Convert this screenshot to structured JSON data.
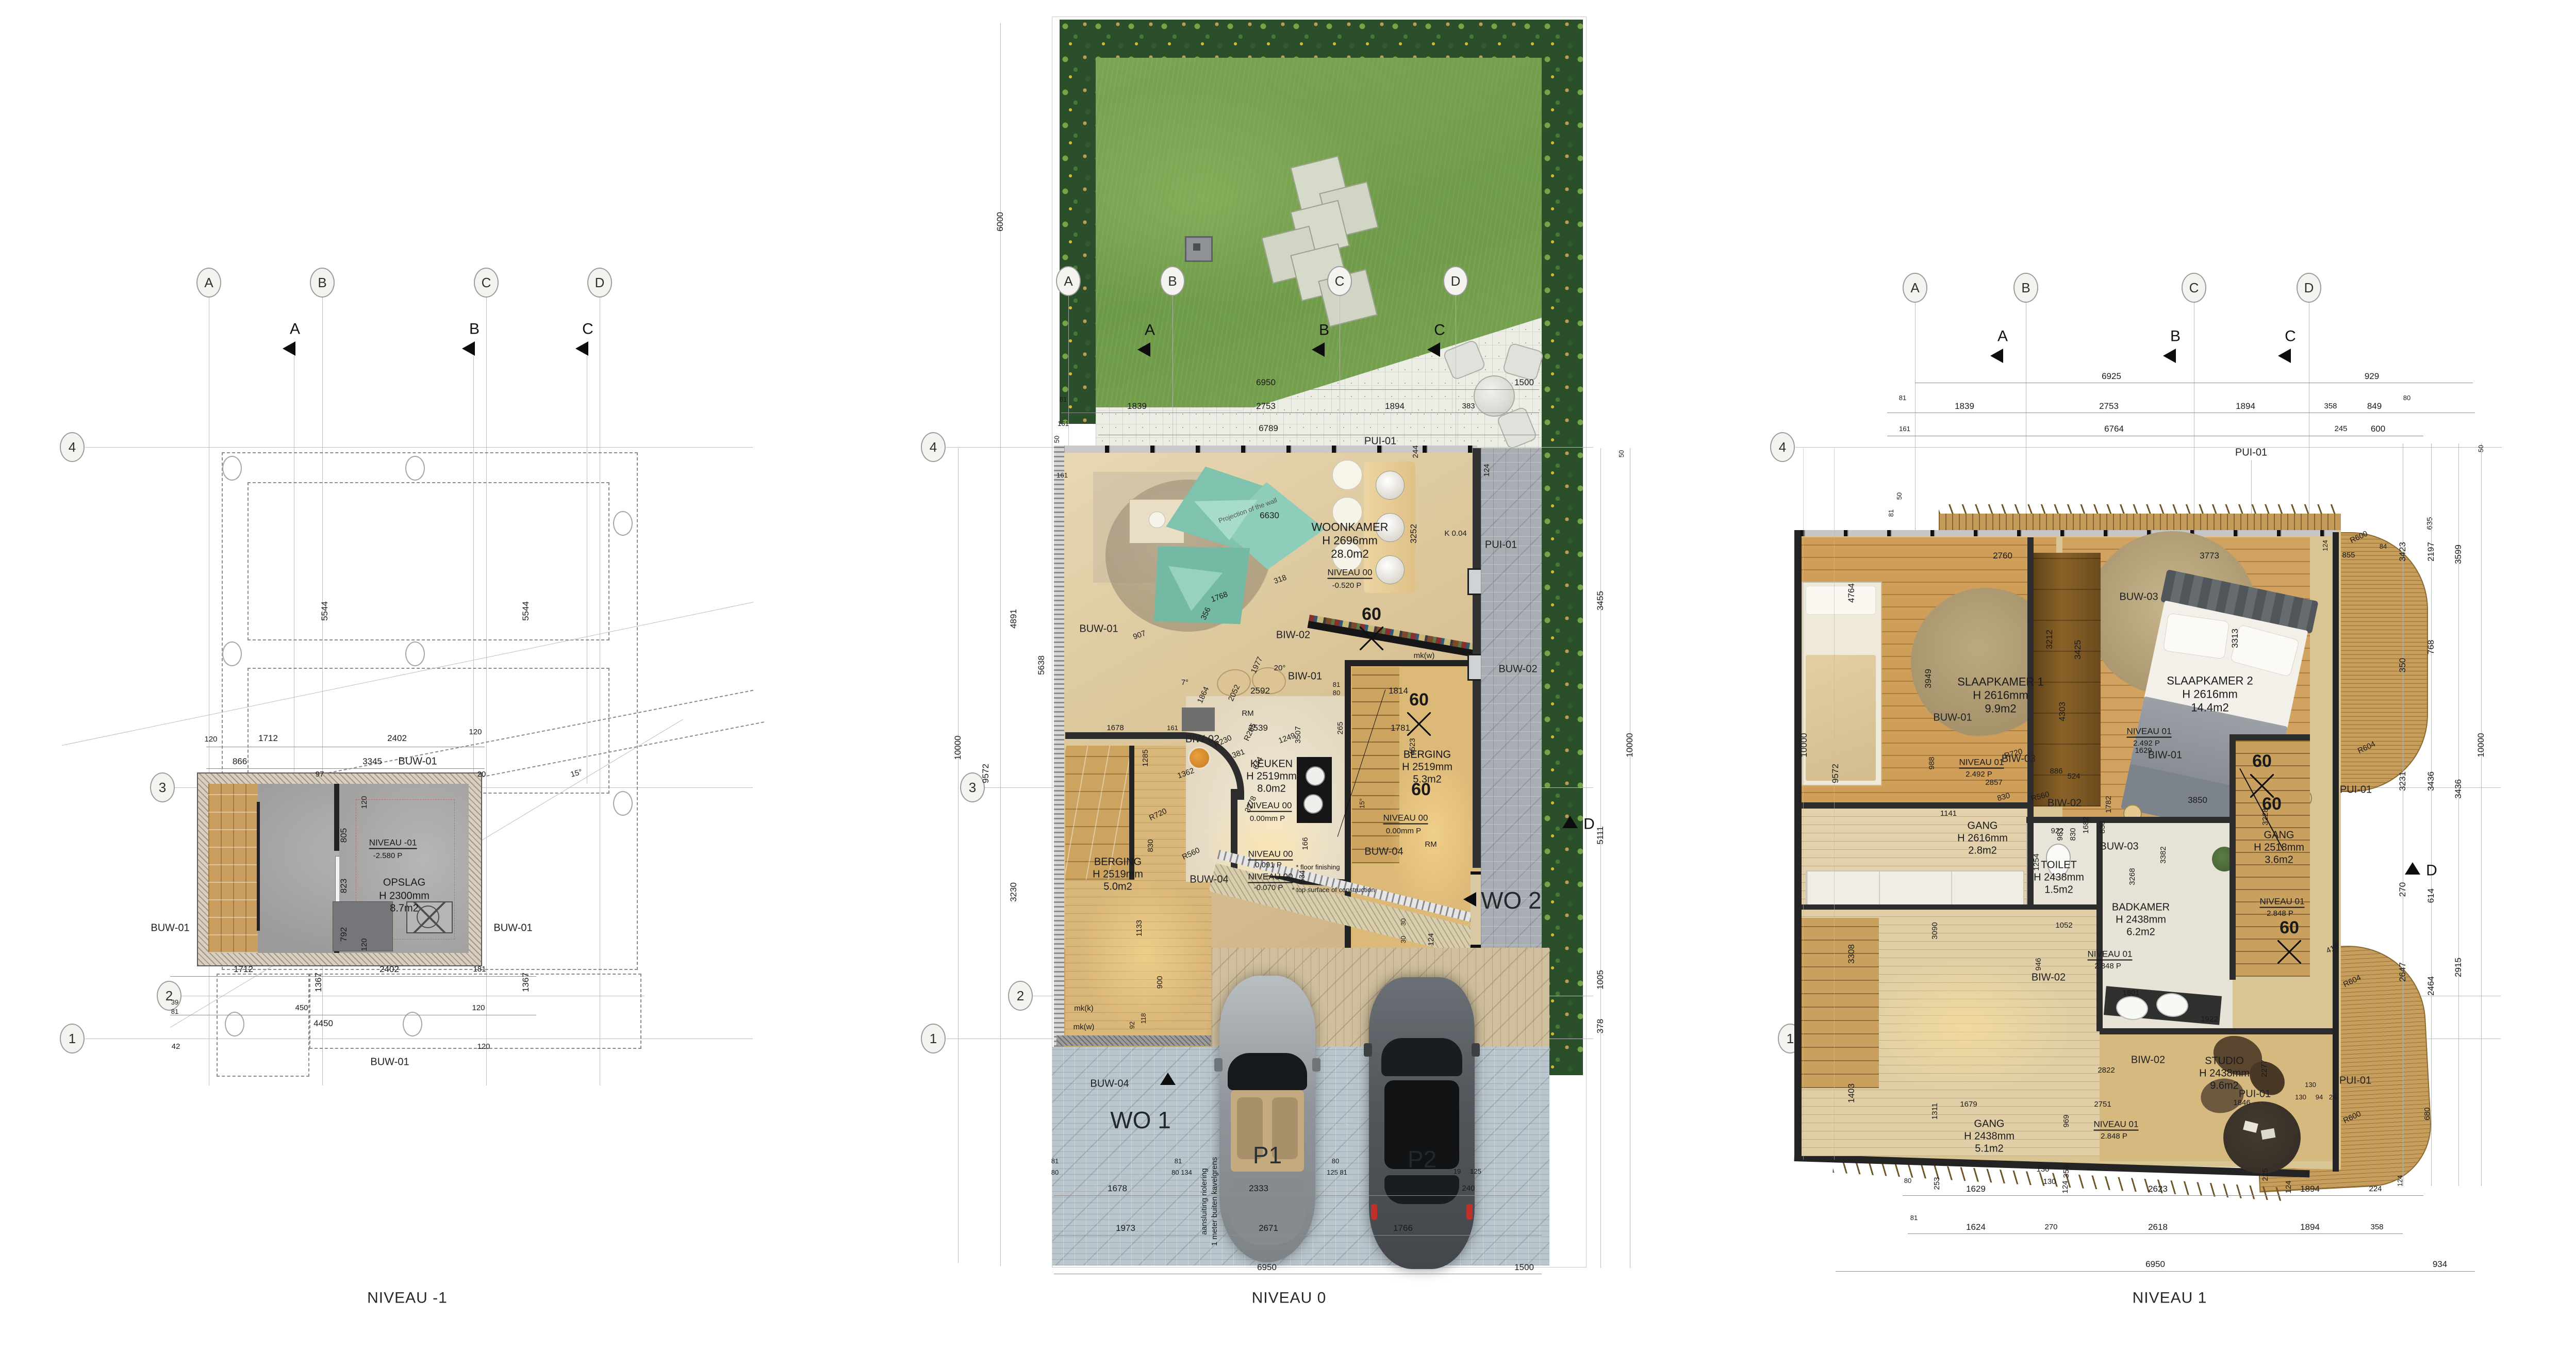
{
  "grid": {
    "cols": [
      "A",
      "B",
      "C",
      "D"
    ],
    "rows": [
      "4",
      "3",
      "2",
      "1"
    ],
    "secs": [
      "A",
      "B",
      "C"
    ],
    "dsec": "D"
  },
  "m1": {
    "title": "NIVEAU -1",
    "room": [
      "OPSLAG",
      "H 2300mm",
      "8.7m2"
    ],
    "lvl": [
      "NIVEAU -01",
      "-2.580 P"
    ],
    "buw": "BUW-01",
    "d": [
      "120",
      "1712",
      "2402",
      "120",
      "866",
      "97",
      "3345",
      "20",
      "805",
      "823",
      "792",
      "120",
      "120",
      "5544",
      "5544",
      "1712",
      "1367",
      "2402",
      "181",
      "1367",
      "39",
      "81",
      "450",
      "4450",
      "120",
      "42",
      "120",
      "15°"
    ]
  },
  "n0": {
    "title": "NIVEAU 0",
    "wk": [
      "WOONKAMER",
      "H 2696mm",
      "28.0m2"
    ],
    "kk": [
      "KEUKEN",
      "H 2519mm",
      "8.0m2"
    ],
    "bgr": [
      "BERGING",
      "H 2519mm",
      "5.3m2"
    ],
    "bgl": [
      "BERGING",
      "H 2519mm",
      "5.0m2"
    ],
    "lv1": [
      "NIVEAU 00",
      "-0.520 P"
    ],
    "lv2": [
      "NIVEAU 00",
      "0.00mm P"
    ],
    "lv3": [
      "NIVEAU 00",
      "0.091 P",
      "* floor finishing"
    ],
    "lv4": [
      "NIVEAU 00",
      "-0.070 P",
      "* top surface of construction"
    ],
    "buw01": "BUW-01",
    "buw02": "BUW-02",
    "buw04": "BUW-04",
    "biw01": "BIW-01",
    "biw02": "BIW-02",
    "pui": "PUI-01",
    "proj": "Projection of the wall",
    "rm": "RM",
    "k004": "K 0.04",
    "mkw": "mk(w)",
    "mkk": "mk(k)",
    "wo1": "WO 1",
    "wo2": "WO 2",
    "p1": "P1",
    "p2": "P2",
    "note": [
      "aansluiting riolering",
      "1 meter buiten kavelgrens"
    ],
    "d": [
      "6950",
      "1500",
      "81",
      "1839",
      "2753",
      "1894",
      "383",
      "161",
      "6789",
      "6630",
      "318",
      "1768",
      "356",
      "907",
      "1977",
      "20°",
      "7°",
      "1864",
      "2052",
      "R230",
      "R285",
      "381",
      "644",
      "1249",
      "1362",
      "R720",
      "R560",
      "3252",
      "124",
      "244",
      "50",
      "2592",
      "2539",
      "3507",
      "3278",
      "1678",
      "161",
      "161",
      "1285",
      "830",
      "1133",
      "900",
      "92",
      "118",
      "265",
      "81",
      "80",
      "1814",
      "1781",
      "4523",
      "15°",
      "166",
      "534",
      "30",
      "30",
      "124",
      "1678",
      "1973",
      "2333",
      "2671",
      "6950",
      "1500",
      "1766",
      "240",
      "19",
      "125",
      "80",
      "125 81",
      "81",
      "80 134",
      "81",
      "80",
      "6000",
      "10000",
      "9572",
      "4891",
      "5638",
      "3230",
      "3455",
      "10000",
      "5111",
      "1005",
      "378",
      "50",
      "60",
      "60",
      "60"
    ]
  },
  "n1": {
    "title": "NIVEAU 1",
    "sk1": [
      "SLAAPKAMER 1",
      "H 2616mm",
      "9.9m2"
    ],
    "sk2": [
      "SLAAPKAMER 2",
      "H 2616mm",
      "14.4m2"
    ],
    "g1": [
      "GANG",
      "H 2616mm",
      "2.8m2"
    ],
    "to": [
      "TOILET",
      "H 2438mm",
      "1.5m2"
    ],
    "bad": [
      "BADKAMER",
      "H 2438mm",
      "6.2m2"
    ],
    "g2": [
      "GANG",
      "H 2518mm",
      "3.6m2"
    ],
    "st": [
      "STUDIO",
      "H 2438mm",
      "9.6m2"
    ],
    "g3": [
      "GANG",
      "H 2438mm",
      "5.1m2"
    ],
    "lva": [
      "NIVEAU 01",
      "2.492 P"
    ],
    "lvb": [
      "NIVEAU 01",
      "2.848 P"
    ],
    "buw01": "BUW-01",
    "buw03": "BUW-03",
    "biw01": "BIW-01",
    "biw02": "BIW-02",
    "biw03": "BIW-03",
    "pui": "PUI-01",
    "d": [
      "6925",
      "929",
      "81",
      "1839",
      "2753",
      "1894",
      "358",
      "849",
      "80",
      "161",
      "6764",
      "245",
      "600",
      "2760",
      "3773",
      "3212",
      "3425",
      "4303",
      "3949",
      "3313",
      "2857",
      "886",
      "830",
      "1141",
      "983",
      "830",
      "838",
      "3850",
      "1629",
      "524",
      "922",
      "1682",
      "1782",
      "1254",
      "3382",
      "3268",
      "1052",
      "946",
      "1801",
      "3228",
      "1922",
      "2277",
      "1846",
      "130",
      "130",
      "94",
      "24",
      "225",
      "2822",
      "2751",
      "969",
      "359",
      "1679",
      "1311",
      "253",
      "124",
      "124",
      "988",
      "3090",
      "R600",
      "R604",
      "R604",
      "R600",
      "855",
      "84",
      "124",
      "635",
      "416",
      "680",
      "3423",
      "350",
      "3231",
      "270",
      "2647",
      "2197",
      "768",
      "3436",
      "614",
      "2464",
      "3599",
      "3436",
      "2915",
      "50",
      "10000",
      "10000",
      "9572",
      "4764",
      "3308",
      "1403",
      "81",
      "50",
      "80",
      "130",
      "130",
      "1629",
      "2623",
      "1894",
      "224",
      "124",
      "81",
      "1624",
      "270",
      "2618",
      "1894",
      "358",
      "6950",
      "934",
      "60",
      "60",
      "60",
      "R720",
      "R560"
    ]
  }
}
